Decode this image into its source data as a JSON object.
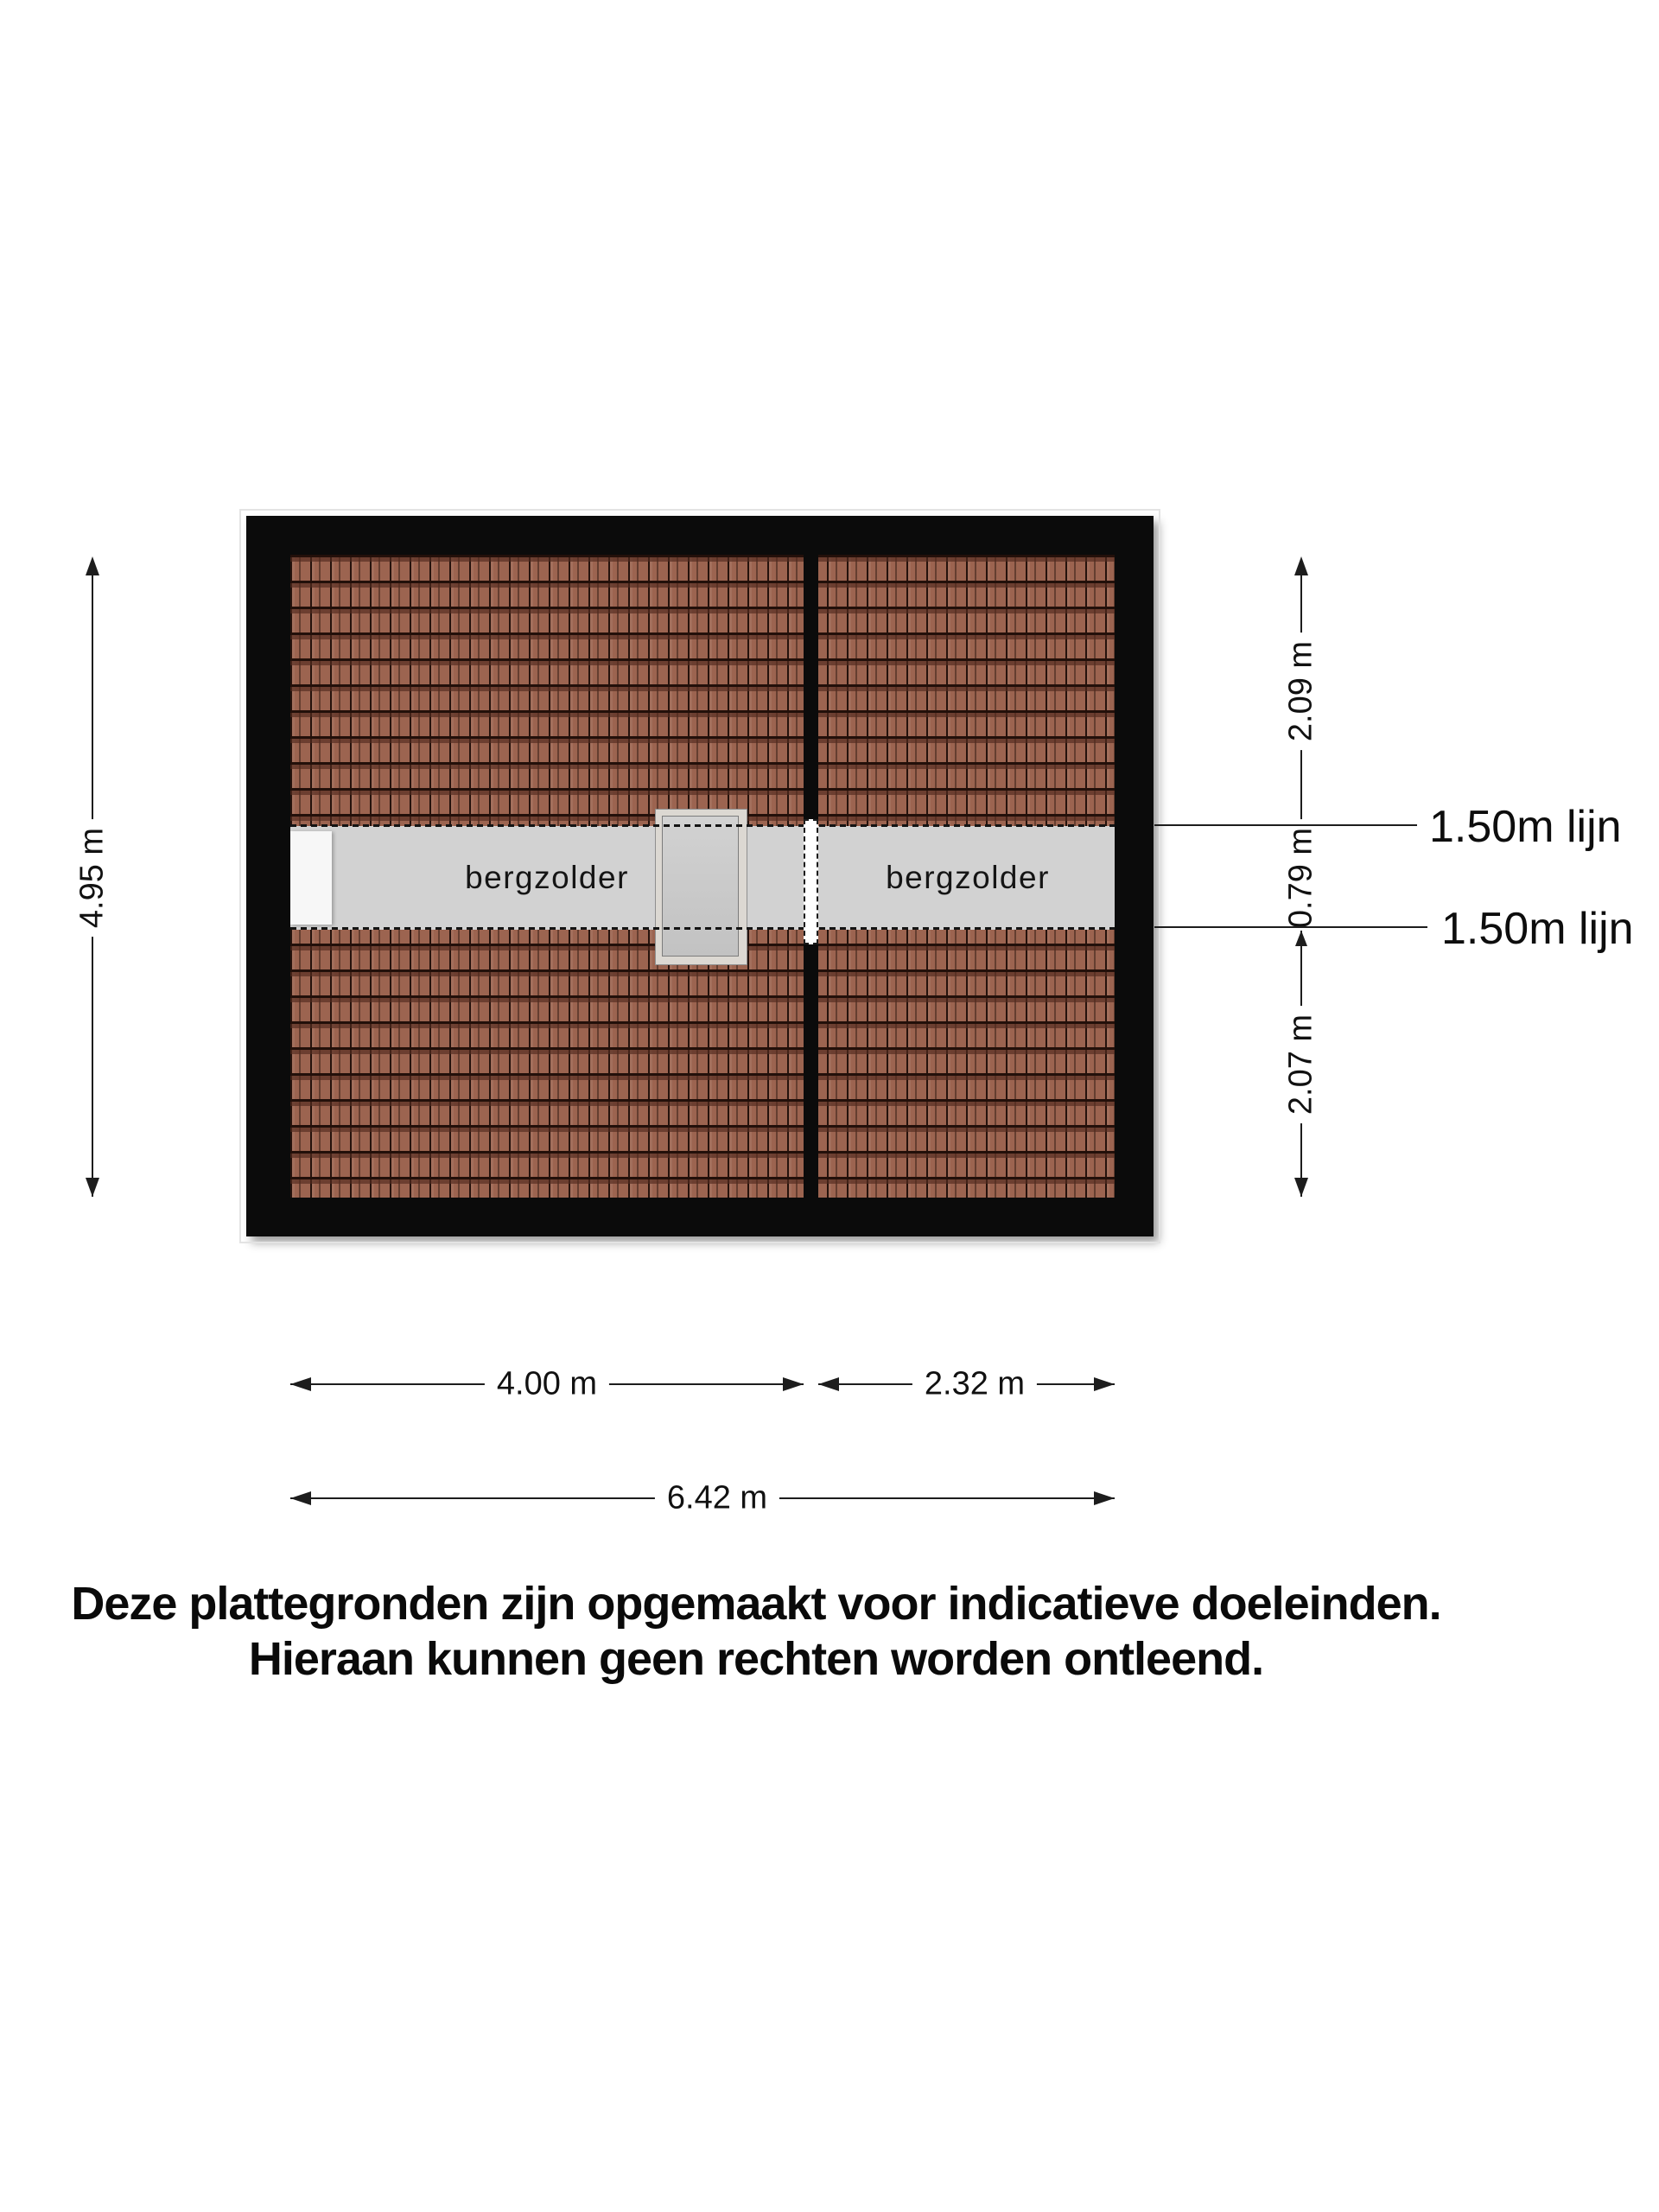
{
  "plan": {
    "rooms": [
      {
        "label": "bergzolder"
      },
      {
        "label": "bergzolder"
      }
    ],
    "dims": {
      "height_total": "4.95 m",
      "right_top": "2.09 m",
      "right_middle": "0.79 m",
      "right_bottom": "2.07 m",
      "width_left": "4.00 m",
      "width_right": "2.32 m",
      "width_total": "6.42 m"
    },
    "headroom_lines": [
      {
        "label": "1.50m lijn"
      },
      {
        "label": "1.50m lijn"
      }
    ],
    "colors": {
      "wall": "#0b0b0b",
      "roof_tile": "#9c6450",
      "attic_floor": "#d2d2d2",
      "dormer_outer": "#dcd8d2",
      "dormer_inner": "#c9c9c9",
      "opening": "#ffffff"
    }
  },
  "disclaimer": {
    "line1": "Deze plattegronden zijn opgemaakt voor indicatieve doeleinden.",
    "line2": "Hieraan kunnen geen rechten worden ontleend."
  }
}
